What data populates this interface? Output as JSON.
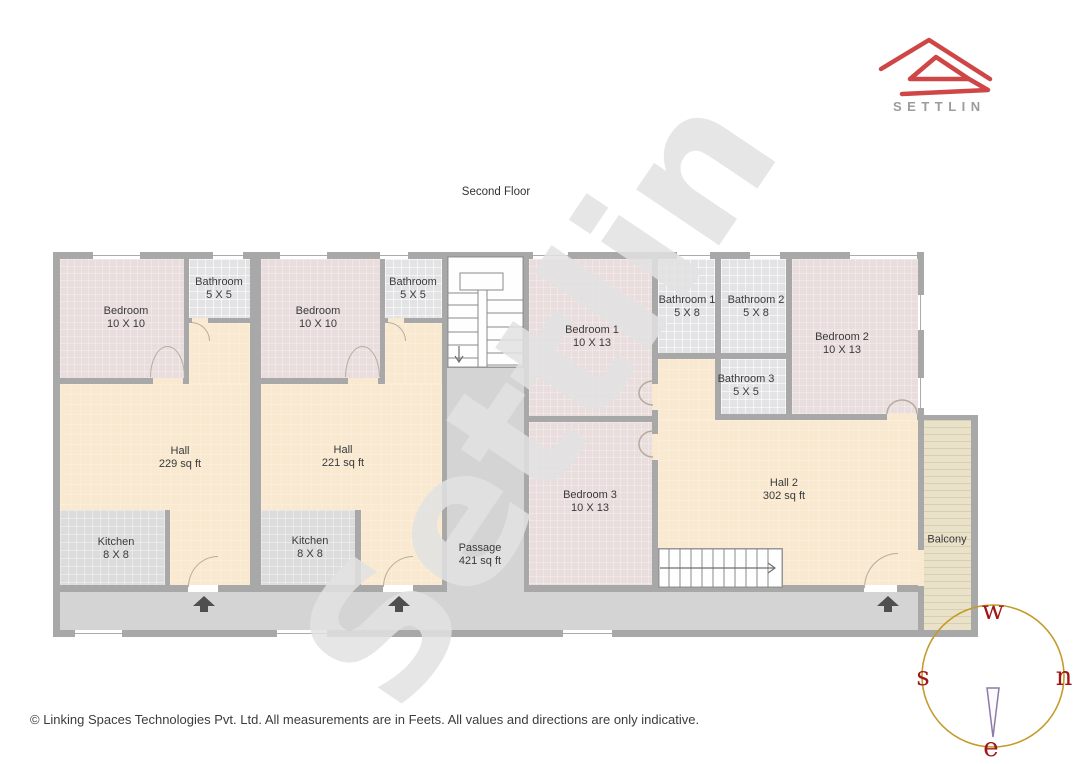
{
  "header": {
    "brand": "SETTLIN"
  },
  "title": "Second Floor",
  "watermark": "Settlin",
  "rooms": {
    "bedroom_u1": {
      "name": "Bedroom",
      "dims": "10 X 10"
    },
    "bath_u1": {
      "name": "Bathroom",
      "dims": "5 X 5"
    },
    "bedroom_u2": {
      "name": "Bedroom",
      "dims": "10 X 10"
    },
    "bath_u2": {
      "name": "Bathroom",
      "dims": "5 X 5"
    },
    "bedroom1": {
      "name": "Bedroom 1",
      "dims": "10 X 13"
    },
    "bath1": {
      "name": "Bathroom 1",
      "dims": "5 X 8"
    },
    "bath2": {
      "name": "Bathroom 2",
      "dims": "5 X 8"
    },
    "bath3": {
      "name": "Bathroom 3",
      "dims": "5 X 5"
    },
    "bedroom2": {
      "name": "Bedroom 2",
      "dims": "10 X 13"
    },
    "bedroom3": {
      "name": "Bedroom 3",
      "dims": "10 X 13"
    },
    "hall_u1": {
      "name": "Hall",
      "dims": "229 sq ft"
    },
    "hall_u2": {
      "name": "Hall",
      "dims": "221 sq ft"
    },
    "kitchen_u1": {
      "name": "Kitchen",
      "dims": "8 X 8"
    },
    "kitchen_u2": {
      "name": "Kitchen",
      "dims": "8 X 8"
    },
    "hall2": {
      "name": "Hall 2",
      "dims": "302 sq ft"
    },
    "passage": {
      "name": "Passage",
      "dims": "421 sq ft"
    },
    "balcony": {
      "name": "Balcony",
      "dims": ""
    }
  },
  "compass": {
    "top": "w",
    "left": "s",
    "right": "n",
    "bottom": "e"
  },
  "footer": {
    "copyright": "© Linking Spaces Technologies Pvt. Ltd. All measurements are in Feets. All values and directions are only indicative."
  },
  "colors": {
    "wall": "#a8a8a8",
    "bedroom": "#e9dddd",
    "bathroom": "#e3e3e6",
    "hall": "#f9e9d1",
    "kitchen": "#dcdcdd",
    "passage": "#d4d4d4",
    "balcony": "#eae1c9",
    "logo_red": "#cf4646",
    "brand_gray": "#9c9c9c",
    "compass_ring": "#c49b2a",
    "compass_letters": "#a01717",
    "entrance_arrow": "#4f4f4f"
  }
}
